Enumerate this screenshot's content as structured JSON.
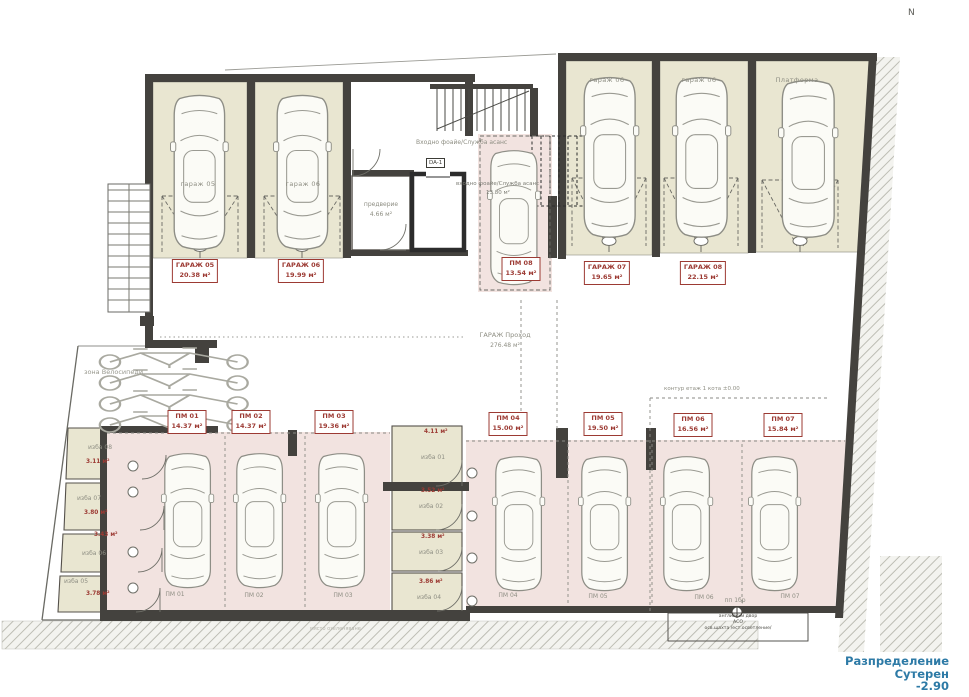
{
  "compass": "N",
  "title_block": {
    "line1": "Разпределение",
    "line2": "Сутерен",
    "line3": "-2.90"
  },
  "colors": {
    "room_beige": "#e9e6d1",
    "parking_pink": "#f2e3e0",
    "label_red": "#9c3a33",
    "wall_dark": "#44423e",
    "title_blue": "#2d7aa6",
    "text_gray": "#8e8e83"
  },
  "room_labels": [
    {
      "text": "гараж 05",
      "cx": 198,
      "y": 180
    },
    {
      "text": "гараж 06",
      "cx": 303,
      "y": 180
    },
    {
      "text": "гараж 06",
      "cx": 607,
      "y": 76
    },
    {
      "text": "гараж 06",
      "cx": 699,
      "y": 76
    },
    {
      "text": "Платформа",
      "cx": 797,
      "y": 76
    }
  ],
  "area_tags": [
    {
      "title": "ГАРАЖ 05",
      "area": "20.38 м²",
      "cx": 195,
      "y": 259
    },
    {
      "title": "ГАРАЖ 06",
      "area": "19.99 м²",
      "cx": 301,
      "y": 259
    },
    {
      "title": "ПМ 08",
      "area": "13.54 м²",
      "cx": 521,
      "y": 257
    },
    {
      "title": "ГАРАЖ 07",
      "area": "19.65 м²",
      "cx": 607,
      "y": 261
    },
    {
      "title": "ГАРАЖ 08",
      "area": "22.15 м²",
      "cx": 703,
      "y": 261
    },
    {
      "title": "ПМ 01",
      "area": "14.37 м²",
      "cx": 187,
      "y": 410
    },
    {
      "title": "ПМ 02",
      "area": "14.37 м²",
      "cx": 251,
      "y": 410
    },
    {
      "title": "ПМ 03",
      "area": "19.36 м²",
      "cx": 334,
      "y": 410
    },
    {
      "title": "ПМ 04",
      "area": "15.00 м²",
      "cx": 508,
      "y": 412
    },
    {
      "title": "ПМ 05",
      "area": "19.50 м²",
      "cx": 603,
      "y": 412
    },
    {
      "title": "ПМ 06",
      "area": "16.56 м²",
      "cx": 693,
      "y": 413
    },
    {
      "title": "ПМ 07",
      "area": "15.84 м²",
      "cx": 783,
      "y": 413
    }
  ],
  "floor_labels": [
    {
      "text": "ПМ 01",
      "cx": 175,
      "y": 591
    },
    {
      "text": "ПМ 02",
      "cx": 254,
      "y": 592
    },
    {
      "text": "ПМ 03",
      "cx": 343,
      "y": 592
    },
    {
      "text": "ПМ 04",
      "cx": 508,
      "y": 592
    },
    {
      "text": "ПМ 05",
      "cx": 598,
      "y": 593
    },
    {
      "text": "ПМ 06",
      "cx": 704,
      "y": 594
    },
    {
      "text": "пп 1бр",
      "cx": 735,
      "y": 597
    },
    {
      "text": "ПМ 07",
      "cx": 790,
      "y": 593
    }
  ],
  "cellars_left": [
    {
      "name": "изба 08",
      "area": "3.11 м²",
      "nx": 88,
      "ny": 444,
      "ax": 86,
      "ay": 459
    },
    {
      "name": "изба 07",
      "area": "3.80 м²",
      "nx": 77,
      "ny": 495,
      "ax": 84,
      "ay": 510
    },
    {
      "name": "изба 06",
      "area": "3.43 м²",
      "nx": 82,
      "ny": 550,
      "ax": 94,
      "ay": 532
    },
    {
      "name": "изба 05",
      "area": "3.78 м²",
      "nx": 64,
      "ny": 578,
      "ax": 86,
      "ay": 591
    }
  ],
  "cellars_mid": [
    {
      "name": "изба 01",
      "area": "4.11 м²",
      "nx": 421,
      "ny": 454,
      "ax": 424,
      "ay": 429
    },
    {
      "name": "изба 02",
      "area": "3.52 м²",
      "nx": 419,
      "ny": 503,
      "ax": 421,
      "ay": 488
    },
    {
      "name": "изба 03",
      "area": "3.38 м²",
      "nx": 419,
      "ny": 549,
      "ax": 421,
      "ay": 534
    },
    {
      "name": "изба 04",
      "area": "3.86 м²",
      "nx": 417,
      "ny": 594,
      "ax": 419,
      "ay": 579
    }
  ],
  "annotations": {
    "entry_foyer_top": "Входно фоайе/Служба асанс",
    "entry_foyer_mid": "входно фоайе/Служба асанс",
    "entry_foyer_mid_area": "13.80 м²",
    "vestibule": "предверие",
    "vestibule_area": "4.66 м²",
    "elevator_tag": "DA-1",
    "passage": "ГАРАЖ Проход",
    "passage_area": "276.48 м²",
    "bike_zone": "зона Велосипеди",
    "contour_note": "контур етаж 1 кота ±0.00",
    "court_line1": "английски двор",
    "court_line2": "АСО",
    "court_line3": "осв.шахта /ест.осветление/",
    "green_note": "място озеленяване"
  }
}
